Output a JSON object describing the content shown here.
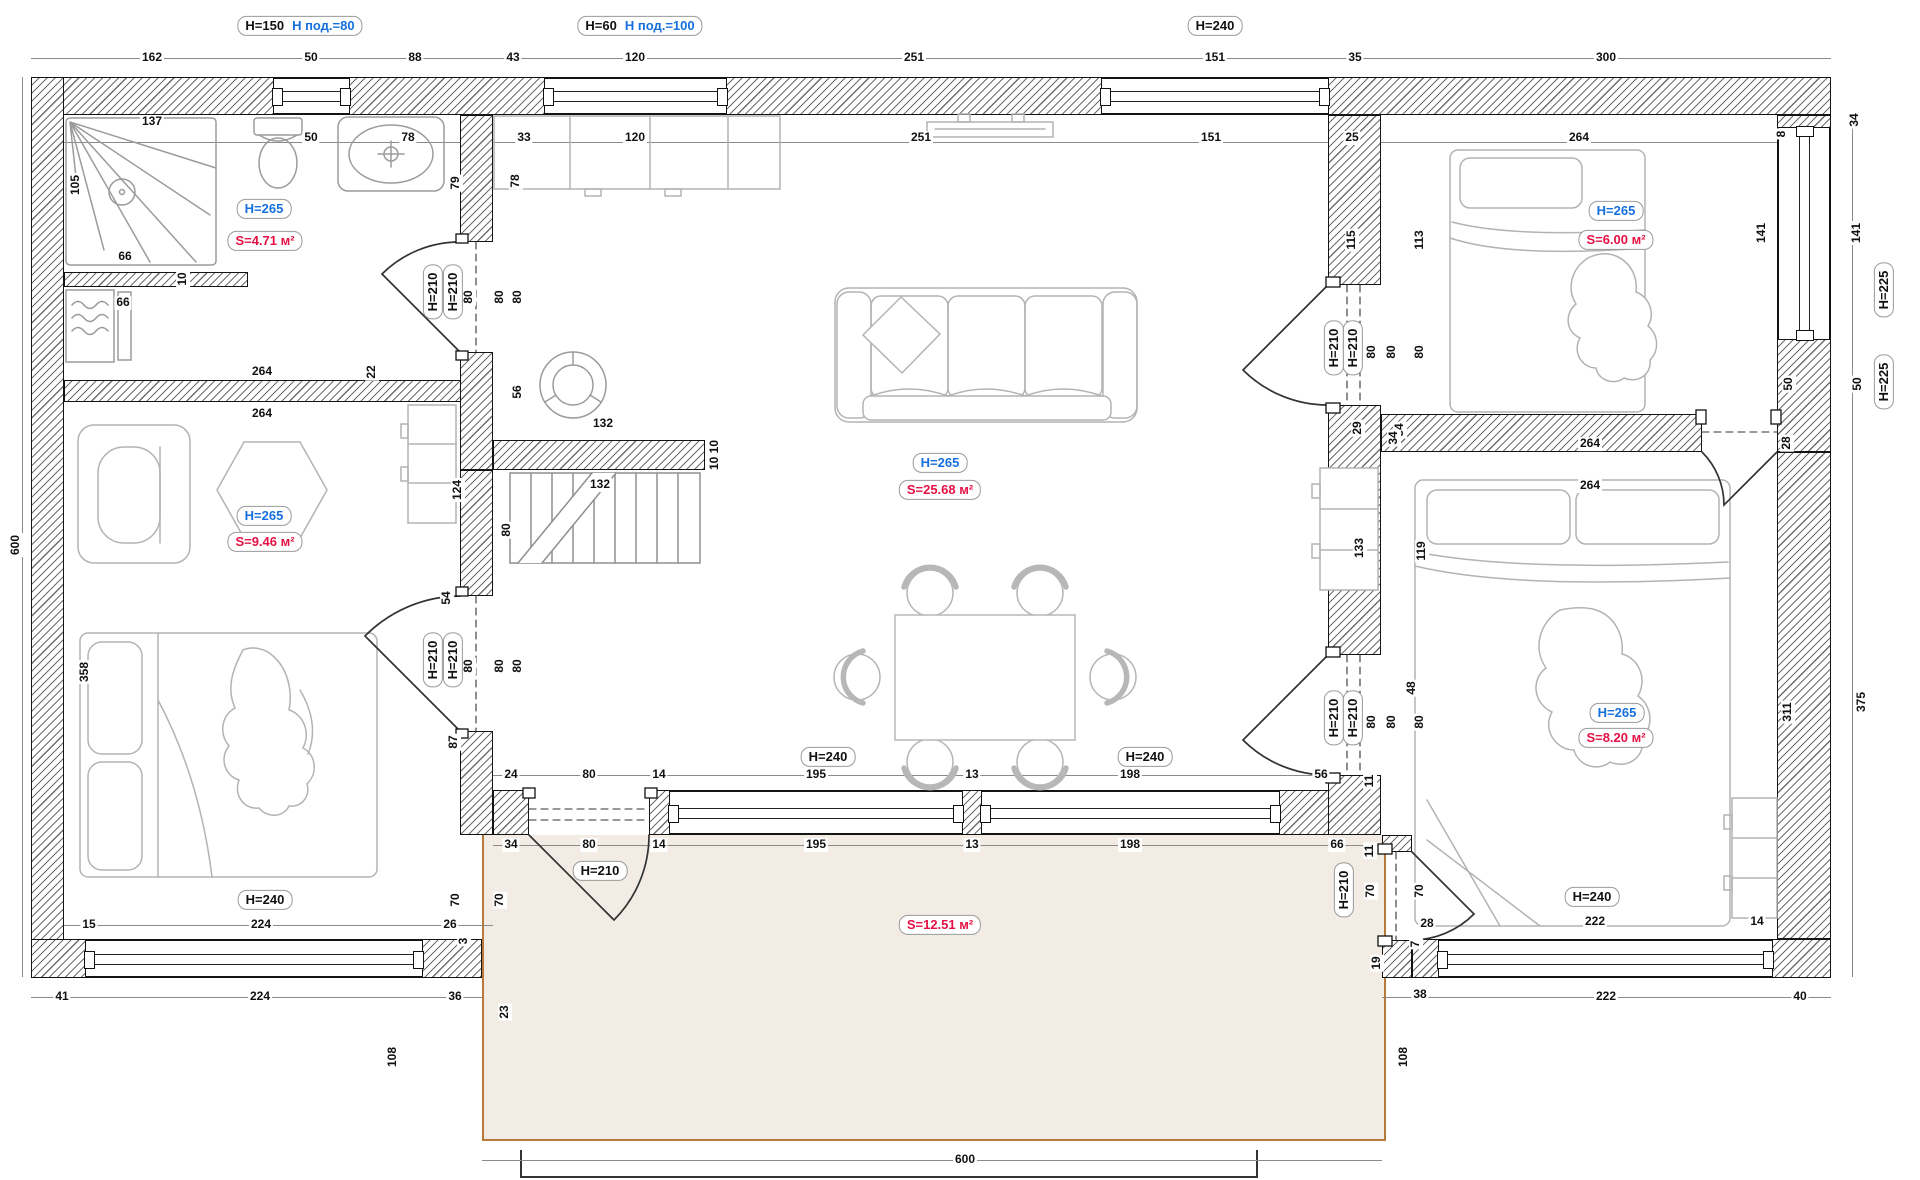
{
  "colors": {
    "height_label": "#1570dd",
    "area_label": "#e51144",
    "dim_text": "#111111",
    "terrace_fill": "#f2ece4",
    "terrace_border": "#b57a3c",
    "wall_hatch": "#6d6d6d"
  },
  "rooms": [
    {
      "name": "bathroom",
      "height": "H=265",
      "area": "S=4.71 м²"
    },
    {
      "name": "left-bedroom",
      "height": "H=265",
      "area": "S=9.46 м²"
    },
    {
      "name": "living-kitchen",
      "height": "H=265",
      "area": "S=25.68 м²"
    },
    {
      "name": "bedroom-top-right",
      "height": "H=265",
      "area": "S=6.00 м²"
    },
    {
      "name": "bedroom-bottom-right",
      "height": "H=265",
      "area": "S=8.20 м²"
    },
    {
      "name": "terrace",
      "area": "S=12.51 м²"
    }
  ],
  "plan": {
    "annotations": [
      {
        "t": "162",
        "x": 152,
        "y": 58,
        "k": "d"
      },
      {
        "t": "50",
        "x": 311,
        "y": 58,
        "k": "d"
      },
      {
        "t": "88",
        "x": 415,
        "y": 58,
        "k": "d"
      },
      {
        "t": "43",
        "x": 513,
        "y": 58,
        "k": "d"
      },
      {
        "t": "120",
        "x": 635,
        "y": 58,
        "k": "d"
      },
      {
        "t": "251",
        "x": 914,
        "y": 58,
        "k": "d"
      },
      {
        "t": "151",
        "x": 1215,
        "y": 58,
        "k": "d"
      },
      {
        "t": "35",
        "x": 1355,
        "y": 58,
        "k": "d"
      },
      {
        "t": "300",
        "x": 1606,
        "y": 58,
        "k": "d"
      },
      {
        "t": "H=150",
        "t2": "Н под.=80",
        "x": 300,
        "y": 26,
        "k": "m"
      },
      {
        "t": "H=60",
        "t2": "Н под.=100",
        "x": 640,
        "y": 26,
        "k": "m"
      },
      {
        "t": "H=240",
        "x": 1215,
        "y": 26,
        "k": "h"
      },
      {
        "t": "50",
        "x": 311,
        "y": 138,
        "k": "d"
      },
      {
        "t": "78",
        "x": 408,
        "y": 138,
        "k": "d"
      },
      {
        "t": "33",
        "x": 524,
        "y": 138,
        "k": "d"
      },
      {
        "t": "120",
        "x": 635,
        "y": 138,
        "k": "d"
      },
      {
        "t": "251",
        "x": 921,
        "y": 138,
        "k": "d"
      },
      {
        "t": "151",
        "x": 1211,
        "y": 138,
        "k": "d"
      },
      {
        "t": "25",
        "x": 1352,
        "y": 138,
        "k": "d"
      },
      {
        "t": "264",
        "x": 1579,
        "y": 138,
        "k": "d"
      },
      {
        "t": "8",
        "x": 1782,
        "y": 134,
        "k": "dv"
      },
      {
        "t": "34",
        "x": 1855,
        "y": 120,
        "k": "dv"
      },
      {
        "t": "141",
        "x": 1762,
        "y": 233,
        "k": "dv"
      },
      {
        "t": "141",
        "x": 1857,
        "y": 233,
        "k": "dv"
      },
      {
        "t": "H=225",
        "x": 1884,
        "y": 290,
        "k": "hv"
      },
      {
        "t": "50",
        "x": 1789,
        "y": 384,
        "k": "dv"
      },
      {
        "t": "50",
        "x": 1858,
        "y": 384,
        "k": "dv"
      },
      {
        "t": "H=225",
        "x": 1884,
        "y": 382,
        "k": "hv"
      },
      {
        "t": "375",
        "x": 1862,
        "y": 702,
        "k": "dv"
      },
      {
        "t": "311",
        "x": 1788,
        "y": 712,
        "k": "dv"
      },
      {
        "t": "105",
        "x": 76,
        "y": 185,
        "k": "dv"
      },
      {
        "t": "137",
        "x": 152,
        "y": 122,
        "k": "d"
      },
      {
        "t": "66",
        "x": 125,
        "y": 257,
        "k": "d"
      },
      {
        "t": "10",
        "x": 183,
        "y": 279,
        "k": "dv"
      },
      {
        "t": "66",
        "x": 123,
        "y": 303,
        "k": "d"
      },
      {
        "t": "79",
        "x": 456,
        "y": 183,
        "k": "dv"
      },
      {
        "t": "78",
        "x": 516,
        "y": 181,
        "k": "dv"
      },
      {
        "t": "H=265",
        "x": 264,
        "y": 209,
        "k": "b"
      },
      {
        "t": "S=4.71 м²",
        "x": 265,
        "y": 241,
        "k": "r"
      },
      {
        "t": "H=210",
        "x": 433,
        "y": 292,
        "k": "hv"
      },
      {
        "t": "H=210",
        "x": 453,
        "y": 292,
        "k": "hv"
      },
      {
        "t": "80",
        "x": 469,
        "y": 297,
        "k": "dv"
      },
      {
        "t": "80",
        "x": 500,
        "y": 297,
        "k": "dv"
      },
      {
        "t": "80",
        "x": 518,
        "y": 297,
        "k": "dv"
      },
      {
        "t": "264",
        "x": 262,
        "y": 372,
        "k": "d"
      },
      {
        "t": "22",
        "x": 372,
        "y": 372,
        "k": "dv"
      },
      {
        "t": "264",
        "x": 262,
        "y": 414,
        "k": "d"
      },
      {
        "t": "H=265",
        "x": 264,
        "y": 516,
        "k": "b"
      },
      {
        "t": "S=9.46 м²",
        "x": 265,
        "y": 542,
        "k": "r"
      },
      {
        "t": "124",
        "x": 458,
        "y": 490,
        "k": "dv"
      },
      {
        "t": "358",
        "x": 85,
        "y": 672,
        "k": "dv"
      },
      {
        "t": "H=210",
        "x": 433,
        "y": 660,
        "k": "hv"
      },
      {
        "t": "H=210",
        "x": 453,
        "y": 660,
        "k": "hv"
      },
      {
        "t": "80",
        "x": 469,
        "y": 666,
        "k": "dv"
      },
      {
        "t": "80",
        "x": 500,
        "y": 666,
        "k": "dv"
      },
      {
        "t": "80",
        "x": 518,
        "y": 666,
        "k": "dv"
      },
      {
        "t": "H=240",
        "x": 265,
        "y": 900,
        "k": "h"
      },
      {
        "t": "15",
        "x": 89,
        "y": 925,
        "k": "d"
      },
      {
        "t": "224",
        "x": 261,
        "y": 925,
        "k": "d"
      },
      {
        "t": "26",
        "x": 450,
        "y": 925,
        "k": "d"
      },
      {
        "t": "3",
        "x": 464,
        "y": 941,
        "k": "dv"
      },
      {
        "t": "41",
        "x": 62,
        "y": 997,
        "k": "d"
      },
      {
        "t": "224",
        "x": 260,
        "y": 997,
        "k": "d"
      },
      {
        "t": "36",
        "x": 455,
        "y": 997,
        "k": "d"
      },
      {
        "t": "600",
        "x": 16,
        "y": 545,
        "k": "dv"
      },
      {
        "t": "56",
        "x": 518,
        "y": 392,
        "k": "dv"
      },
      {
        "t": "132",
        "x": 603,
        "y": 424,
        "k": "d"
      },
      {
        "t": "132",
        "x": 600,
        "y": 485,
        "k": "d"
      },
      {
        "t": "80",
        "x": 507,
        "y": 530,
        "k": "dv"
      },
      {
        "t": "10 10",
        "x": 715,
        "y": 455,
        "k": "dv"
      },
      {
        "t": "54",
        "x": 447,
        "y": 598,
        "k": "dv"
      },
      {
        "t": "87",
        "x": 454,
        "y": 742,
        "k": "dv"
      },
      {
        "t": "H=265",
        "x": 940,
        "y": 463,
        "k": "b"
      },
      {
        "t": "S=25.68 м²",
        "x": 940,
        "y": 490,
        "k": "r"
      },
      {
        "t": "H=240",
        "x": 828,
        "y": 757,
        "k": "h"
      },
      {
        "t": "H=240",
        "x": 1145,
        "y": 757,
        "k": "h"
      },
      {
        "t": "24",
        "x": 511,
        "y": 775,
        "k": "d"
      },
      {
        "t": "80",
        "x": 589,
        "y": 775,
        "k": "d"
      },
      {
        "t": "14",
        "x": 659,
        "y": 775,
        "k": "d"
      },
      {
        "t": "195",
        "x": 816,
        "y": 775,
        "k": "d"
      },
      {
        "t": "13",
        "x": 972,
        "y": 775,
        "k": "d"
      },
      {
        "t": "198",
        "x": 1130,
        "y": 775,
        "k": "d"
      },
      {
        "t": "56",
        "x": 1321,
        "y": 775,
        "k": "d"
      },
      {
        "t": "11",
        "x": 1370,
        "y": 781,
        "k": "dv"
      },
      {
        "t": "34",
        "x": 511,
        "y": 845,
        "k": "d"
      },
      {
        "t": "80",
        "x": 589,
        "y": 845,
        "k": "d"
      },
      {
        "t": "14",
        "x": 659,
        "y": 845,
        "k": "d"
      },
      {
        "t": "195",
        "x": 816,
        "y": 845,
        "k": "d"
      },
      {
        "t": "13",
        "x": 972,
        "y": 845,
        "k": "d"
      },
      {
        "t": "198",
        "x": 1130,
        "y": 845,
        "k": "d"
      },
      {
        "t": "66",
        "x": 1337,
        "y": 845,
        "k": "d"
      },
      {
        "t": "11",
        "x": 1370,
        "y": 851,
        "k": "dv"
      },
      {
        "t": "48",
        "x": 1412,
        "y": 688,
        "k": "dv"
      },
      {
        "t": "115",
        "x": 1352,
        "y": 240,
        "k": "dv"
      },
      {
        "t": "113",
        "x": 1420,
        "y": 240,
        "k": "dv"
      },
      {
        "t": "H=210",
        "x": 1334,
        "y": 348,
        "k": "hv"
      },
      {
        "t": "H=210",
        "x": 1353,
        "y": 348,
        "k": "hv"
      },
      {
        "t": "80",
        "x": 1372,
        "y": 352,
        "k": "dv"
      },
      {
        "t": "80",
        "x": 1392,
        "y": 352,
        "k": "dv"
      },
      {
        "t": "80",
        "x": 1420,
        "y": 352,
        "k": "dv"
      },
      {
        "t": "29",
        "x": 1358,
        "y": 428,
        "k": "dv"
      },
      {
        "t": "34",
        "x": 1400,
        "y": 430,
        "k": "dv"
      },
      {
        "t": "133",
        "x": 1360,
        "y": 548,
        "k": "dv"
      },
      {
        "t": "119",
        "x": 1422,
        "y": 551,
        "k": "dv"
      },
      {
        "t": "H=210",
        "x": 1334,
        "y": 718,
        "k": "hv"
      },
      {
        "t": "H=210",
        "x": 1353,
        "y": 718,
        "k": "hv"
      },
      {
        "t": "80",
        "x": 1372,
        "y": 722,
        "k": "dv"
      },
      {
        "t": "80",
        "x": 1392,
        "y": 722,
        "k": "dv"
      },
      {
        "t": "80",
        "x": 1420,
        "y": 722,
        "k": "dv"
      },
      {
        "t": "H=265",
        "x": 1616,
        "y": 211,
        "k": "b"
      },
      {
        "t": "S=6.00 м²",
        "x": 1616,
        "y": 240,
        "k": "r"
      },
      {
        "t": "34",
        "x": 1394,
        "y": 438,
        "k": "dv"
      },
      {
        "t": "264",
        "x": 1590,
        "y": 444,
        "k": "d"
      },
      {
        "t": "264",
        "x": 1590,
        "y": 486,
        "k": "d"
      },
      {
        "t": "28",
        "x": 1787,
        "y": 443,
        "k": "dv"
      },
      {
        "t": "H=265",
        "x": 1617,
        "y": 713,
        "k": "b"
      },
      {
        "t": "S=8.20 м²",
        "x": 1616,
        "y": 738,
        "k": "r"
      },
      {
        "t": "H=240",
        "x": 1592,
        "y": 897,
        "k": "h"
      },
      {
        "t": "222",
        "x": 1595,
        "y": 922,
        "k": "d"
      },
      {
        "t": "14",
        "x": 1757,
        "y": 922,
        "k": "d"
      },
      {
        "t": "38",
        "x": 1420,
        "y": 995,
        "k": "d"
      },
      {
        "t": "222",
        "x": 1606,
        "y": 997,
        "k": "d"
      },
      {
        "t": "40",
        "x": 1800,
        "y": 997,
        "k": "d"
      },
      {
        "t": "H=210",
        "x": 1344,
        "y": 890,
        "k": "hv"
      },
      {
        "t": "70",
        "x": 1371,
        "y": 891,
        "k": "dv"
      },
      {
        "t": "70",
        "x": 1420,
        "y": 891,
        "k": "dv"
      },
      {
        "t": "28",
        "x": 1427,
        "y": 924,
        "k": "d"
      },
      {
        "t": "7",
        "x": 1416,
        "y": 944,
        "k": "dv"
      },
      {
        "t": "19",
        "x": 1377,
        "y": 963,
        "k": "dv"
      },
      {
        "t": "108",
        "x": 1404,
        "y": 1057,
        "k": "dv"
      },
      {
        "t": "S=12.51 м²",
        "x": 940,
        "y": 925,
        "k": "r"
      },
      {
        "t": "H=210",
        "x": 600,
        "y": 871,
        "k": "h"
      },
      {
        "t": "70",
        "x": 456,
        "y": 900,
        "k": "dv"
      },
      {
        "t": "70",
        "x": 500,
        "y": 900,
        "k": "dv"
      },
      {
        "t": "23",
        "x": 505,
        "y": 1012,
        "k": "dv"
      },
      {
        "t": "108",
        "x": 393,
        "y": 1057,
        "k": "dv"
      },
      {
        "t": "600",
        "x": 965,
        "y": 1160,
        "k": "d"
      }
    ]
  }
}
